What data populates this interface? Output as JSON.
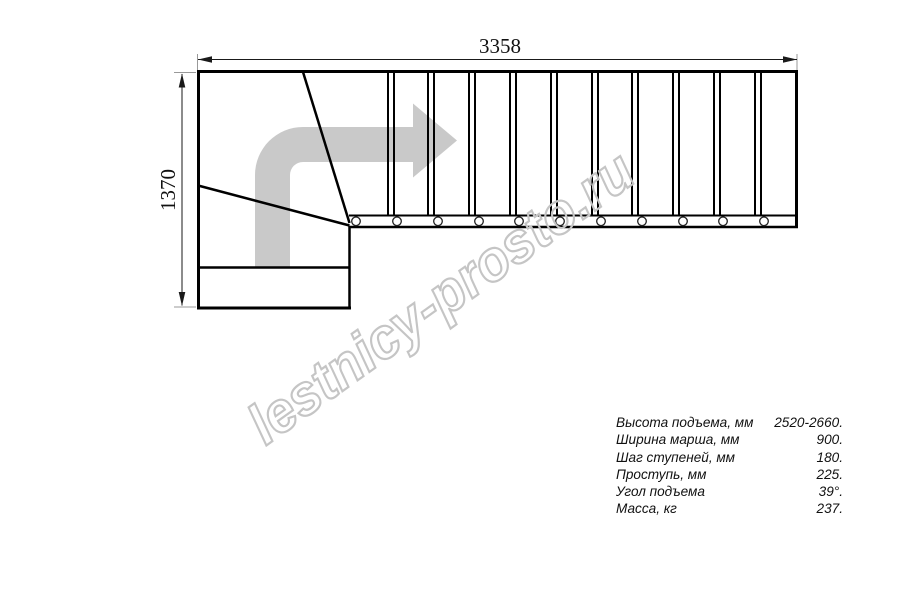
{
  "diagram": {
    "type": "stair-plan-top-view",
    "dimensions": {
      "width_label": "3358",
      "height_label": "1370"
    },
    "straight_tread_count": 11,
    "mount_circle_count": 11
  },
  "geometry": {
    "tread_boundaries_x": [
      391,
      431,
      472,
      513,
      554,
      595,
      635,
      676,
      717,
      758
    ],
    "circle_centers_x": [
      356,
      397,
      438,
      479,
      519,
      560,
      601,
      642,
      683,
      723,
      764
    ]
  },
  "specs": {
    "rows": [
      {
        "label": "Высота подъема, мм",
        "value": "2520-2660."
      },
      {
        "label": "Ширина марша, мм",
        "value": "900."
      },
      {
        "label": "Шаг ступеней, мм",
        "value": "180."
      },
      {
        "label": "Проступь, мм",
        "value": "225."
      },
      {
        "label": "Угол подъема",
        "value": "39°."
      },
      {
        "label": "Масса, кг",
        "value": "237."
      }
    ]
  },
  "watermark": {
    "text": "lestnicy-prosto.ru"
  },
  "colors": {
    "line": "#000000",
    "dimension": "#1a1a1a",
    "extension": "#999999",
    "arrow": "#c9c9c9",
    "watermark": "#c5c5c5",
    "background": "#ffffff"
  }
}
